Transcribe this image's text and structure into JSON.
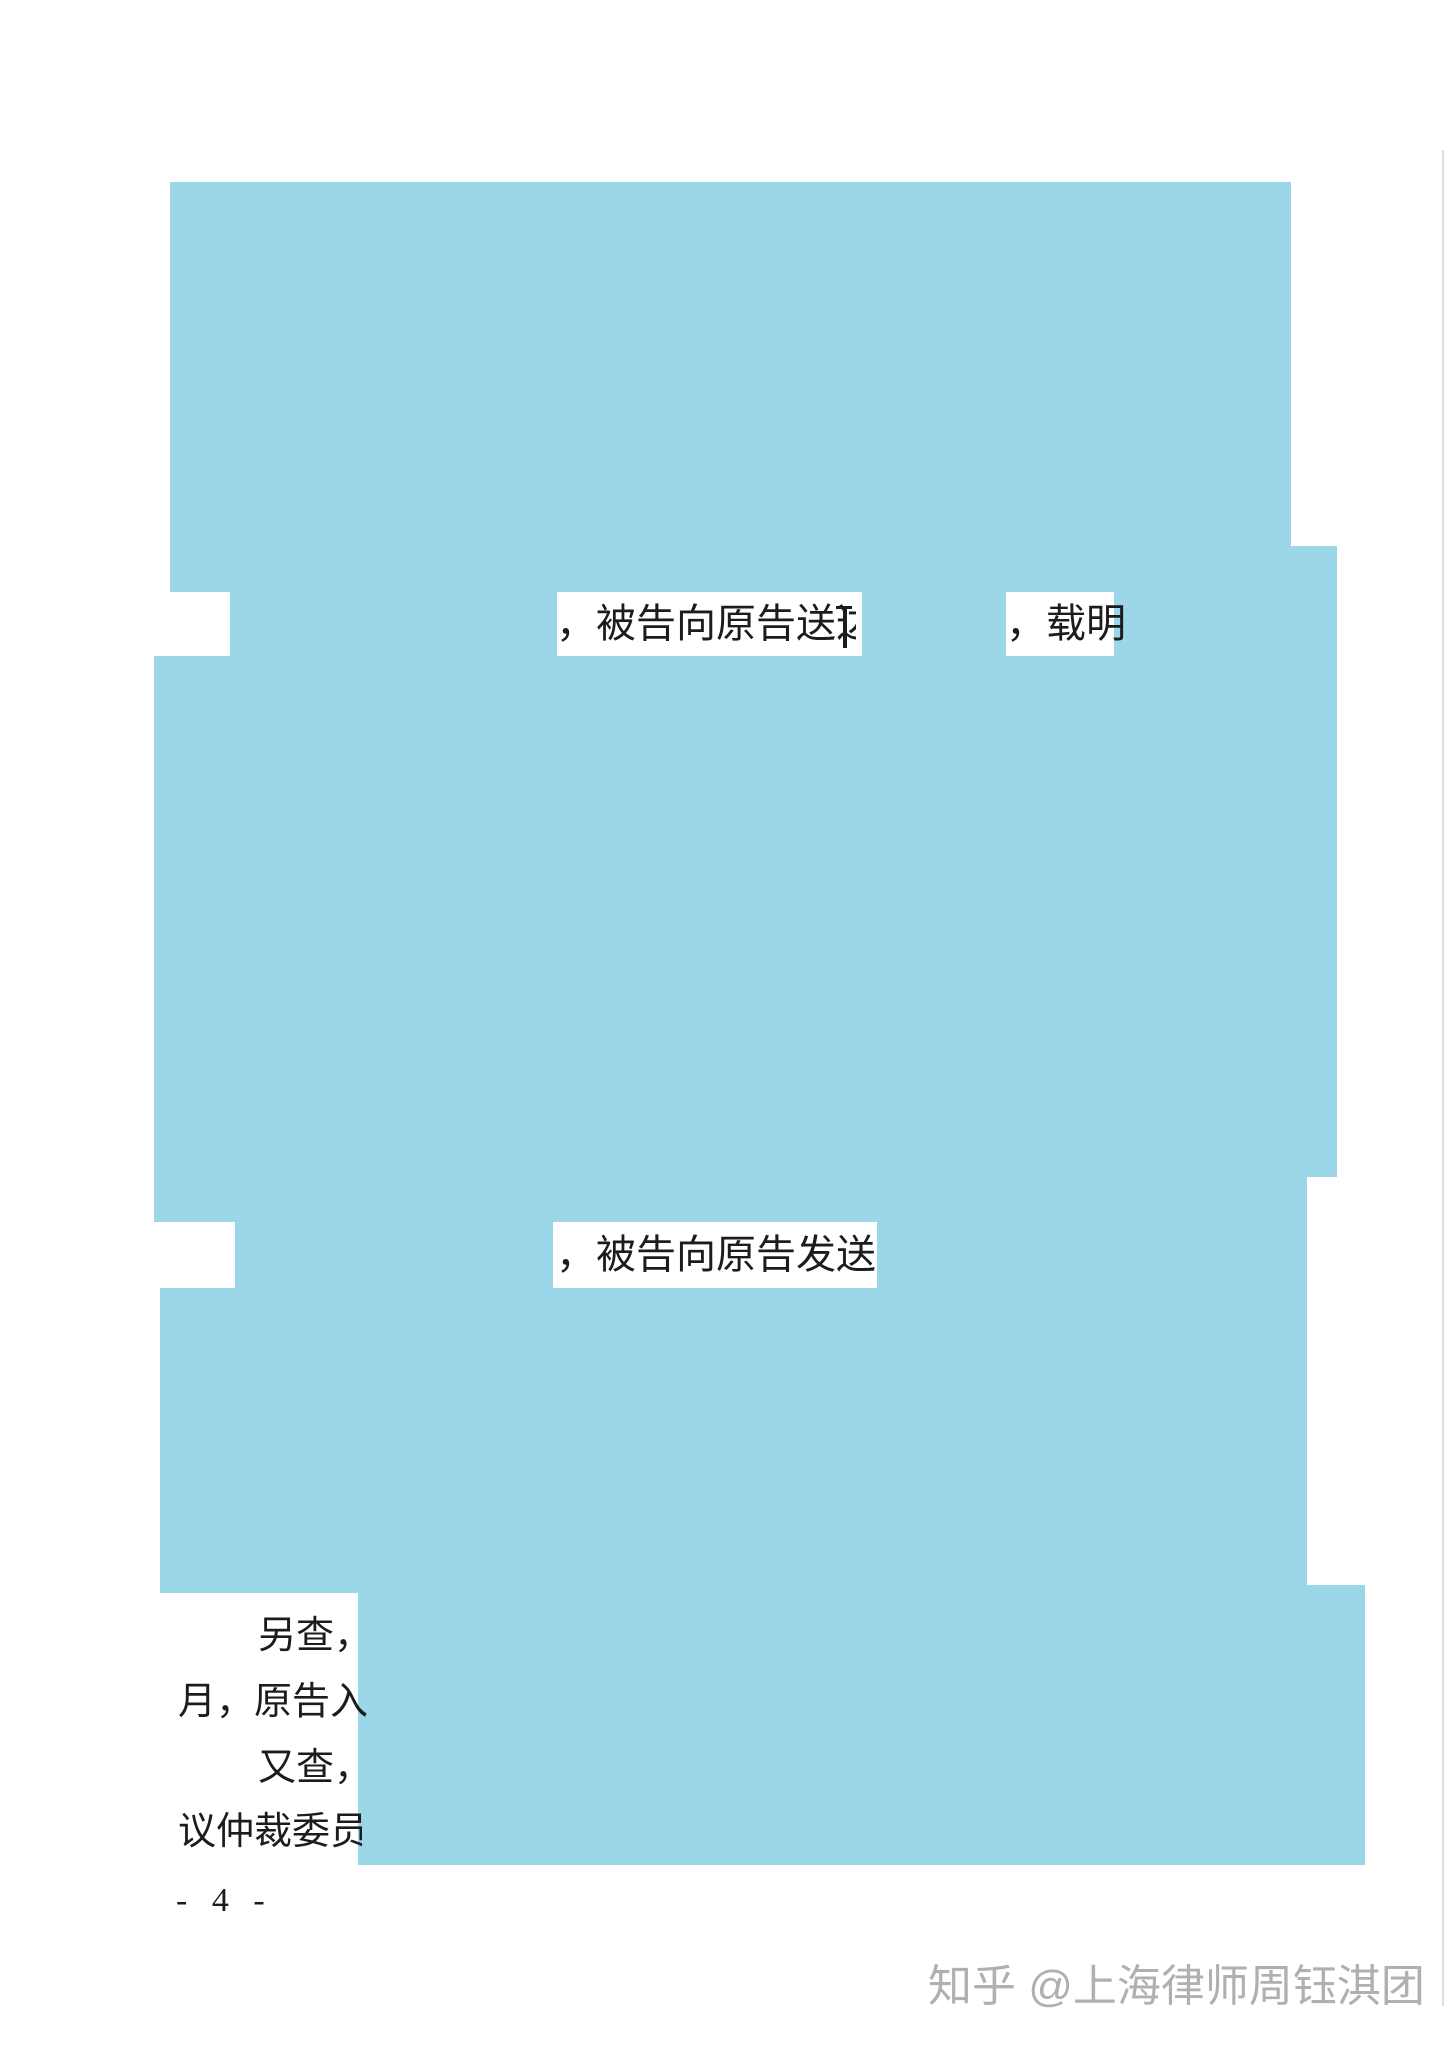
{
  "document": {
    "page_number": "- 4 -",
    "watermark": "知乎 @上海律师周钰淇团",
    "fragments": {
      "line1_left": "，被告向原告送达",
      "line1_right": "，载明",
      "line2": "，被告向原告发送",
      "para_another_line1": "另查，",
      "para_another_line2": "月，原告入",
      "para_further_line1": "又查，",
      "para_further_line2": "议仲裁委员"
    }
  },
  "colors": {
    "redaction_blue": "#9bd7e8",
    "text": "#1c1c1c",
    "watermark_gray": "#b0b0b0",
    "page_edge_line": "#dcdcdc",
    "background": "#ffffff"
  }
}
